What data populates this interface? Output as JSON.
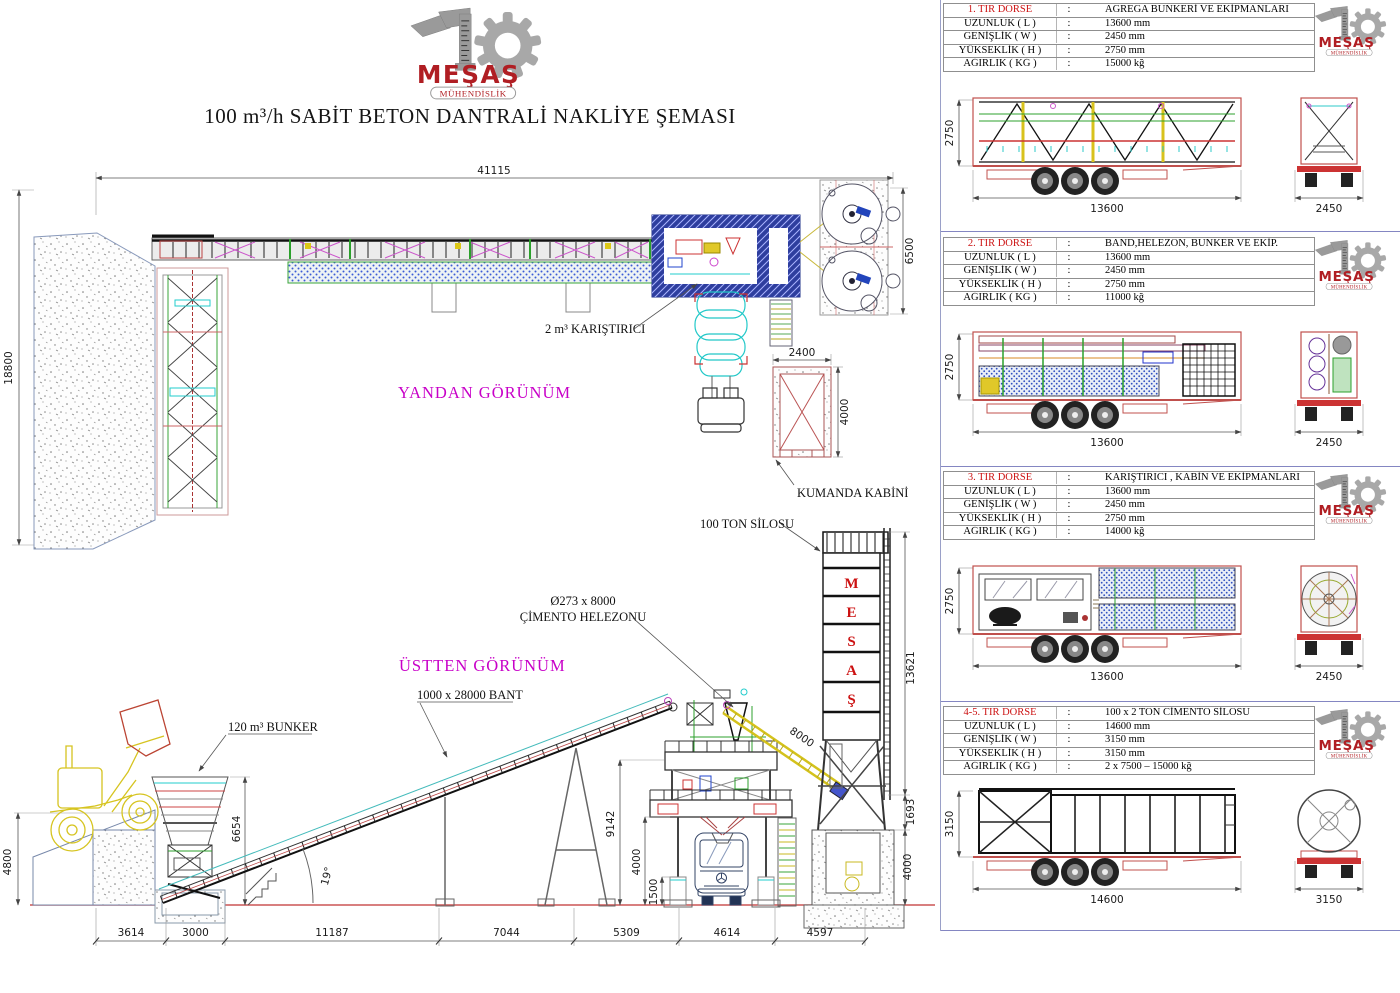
{
  "logo": {
    "name": "MEŞAŞ",
    "subtitle": "MÜHENDİSLİK"
  },
  "title": "100 m³/h SABİT BETON DANTRALİ NAKLİYE ŞEMASI",
  "colon": ":",
  "colors": {
    "brand_red": "#b01e23",
    "table_title_red": "#cc1111",
    "view_label_magenta": "#c800c8",
    "trailer_red": "#c0504d"
  },
  "main_drawing": {
    "view_labels": {
      "side": "YANDAN GÖRÜNÜM",
      "top": "ÜSTTEN GÖRÜNÜM"
    },
    "annotations": {
      "mixer": "2 m³ KARIŞTIRICI",
      "control_cabin": "KUMANDA KABİNİ",
      "silo": "100 TON SİLOSU",
      "screw_line1": "Ø273 x 8000",
      "screw_line2": "ÇİMENTO HELEZONU",
      "belt": "1000 x 28000 BANT",
      "bunker": "120 m³ BUNKER",
      "silo_letters": [
        "M",
        "E",
        "S",
        "A",
        "Ş"
      ]
    },
    "dimensions": {
      "total_length": "41115",
      "stock_height": "18800",
      "silos_width": "6500",
      "cabin_width": "2400",
      "cabin_depth": "4000",
      "ramp_height": "4800",
      "bunker_height": "6654",
      "belt_angle": "19°",
      "tower_height": "9142",
      "tower_clearance": "4000",
      "pedestal_height": "1500",
      "screw_length": "8000",
      "silo_height": "13621",
      "silo_gap": "1693",
      "silo_leg_height": "4000",
      "bottom_chain": [
        "3614",
        "3000",
        "11187",
        "7044",
        "5309",
        "4614",
        "4597"
      ]
    }
  },
  "panels": [
    {
      "no": "1. TIR DORSE",
      "cargo": "AGREGA BUNKERİ VE EKİPMANLARI",
      "rows": [
        {
          "label": "UZUNLUK ( L )",
          "value": "13600 mm"
        },
        {
          "label": "GENİŞLİK ( W )",
          "value": "2450 mm"
        },
        {
          "label": "YÜKSEKLİK ( H )",
          "value": "2750 mm"
        },
        {
          "label": "AĞIRLIK ( KĞ )",
          "value": "15000 kğ"
        }
      ],
      "side_height": "2750",
      "side_length": "13600",
      "rear_width": "2450",
      "load": "truss"
    },
    {
      "no": "2. TIR DORSE",
      "cargo": "BAND,HELEZON, BUNKER VE EKİP.",
      "rows": [
        {
          "label": "UZUNLUK ( L )",
          "value": "13600 mm"
        },
        {
          "label": "GENİŞLİK ( W )",
          "value": "2450 mm"
        },
        {
          "label": "YÜKSEKLİK ( H )",
          "value": "2750 mm"
        },
        {
          "label": "AĞIRLIK ( KĞ )",
          "value": "11000 kğ"
        }
      ],
      "side_height": "2750",
      "side_length": "13600",
      "rear_width": "2450",
      "load": "parts"
    },
    {
      "no": "3. TIR DORSE",
      "cargo": "KARIŞTIRICI , KABİN VE EKİPMANLARI",
      "rows": [
        {
          "label": "UZUNLUK ( L )",
          "value": "13600 mm"
        },
        {
          "label": "GENİŞLİK ( W )",
          "value": "2450 mm"
        },
        {
          "label": "YÜKSEKLİK ( H )",
          "value": "2750 mm"
        },
        {
          "label": "AĞIRLIK ( KĞ )",
          "value": "14000 kğ"
        }
      ],
      "side_height": "2750",
      "side_length": "13600",
      "rear_width": "2450",
      "load": "mixer"
    },
    {
      "no": "4-5. TIR DORSE",
      "cargo": "100 x 2 TON CİMENTO SİLOSU",
      "rows": [
        {
          "label": "UZUNLUK ( L )",
          "value": "14600 mm"
        },
        {
          "label": "GENİŞLİK ( W )",
          "value": "3150 mm"
        },
        {
          "label": "YÜKSEKLİK ( H )",
          "value": "3150 mm"
        },
        {
          "label": "AĞIRLIK ( KĞ )",
          "value": "2 x 7500 – 15000 kğ"
        }
      ],
      "side_height": "3150",
      "side_length": "14600",
      "rear_width": "3150",
      "load": "silo"
    }
  ]
}
